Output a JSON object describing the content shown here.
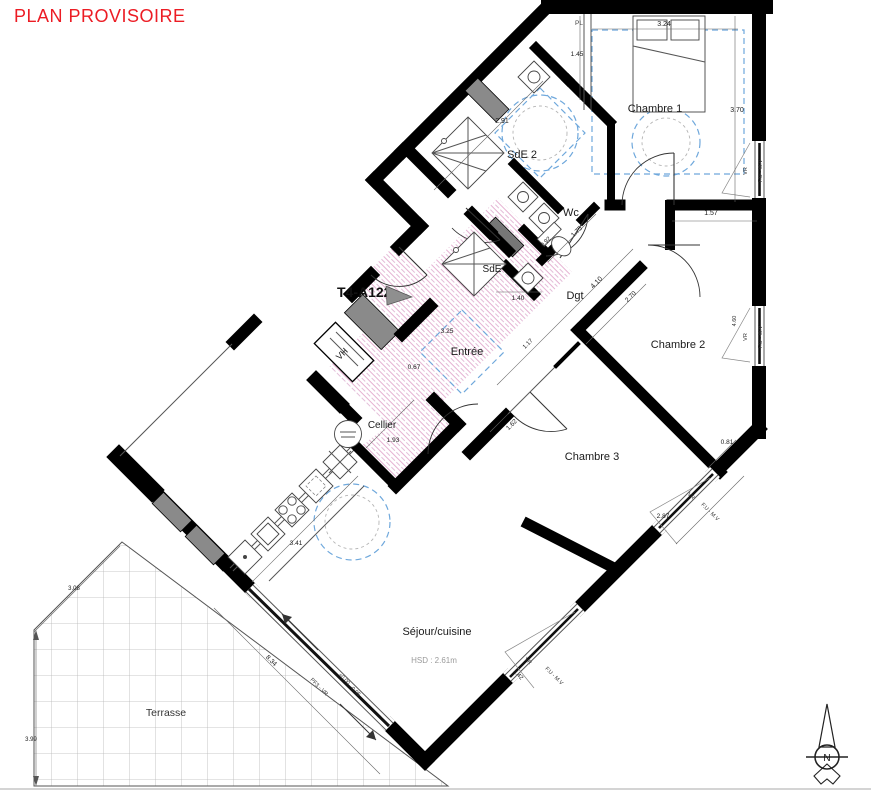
{
  "header": {
    "title": "PLAN PROVISOIRE",
    "color": "#ec1c24"
  },
  "unit": {
    "label": "T4-A122"
  },
  "compass": {
    "label": "N"
  },
  "colors": {
    "wall": "#000000",
    "accent_red": "#ec1c24",
    "hatch_pink": "#cf7fb4",
    "accessibility_blue": "#6fa8dc",
    "structural_gray": "#8a8a8a"
  },
  "labels": [
    {
      "id": "room-label-chambre1",
      "t": "Chambre 1",
      "x": 655,
      "y": 112,
      "s": 11
    },
    {
      "id": "room-label-chambre2",
      "t": "Chambre 2",
      "x": 678,
      "y": 348,
      "s": 11
    },
    {
      "id": "room-label-chambre3",
      "t": "Chambre 3",
      "x": 592,
      "y": 460,
      "s": 11
    },
    {
      "id": "room-label-sde2",
      "t": "SdE 2",
      "x": 522,
      "y": 158,
      "s": 11
    },
    {
      "id": "room-label-sde",
      "t": "SdE",
      "x": 492,
      "y": 272,
      "s": 10
    },
    {
      "id": "room-label-wc",
      "t": "Wc",
      "x": 571,
      "y": 216,
      "s": 11
    },
    {
      "id": "room-label-dgt",
      "t": "Dgt",
      "x": 575,
      "y": 299,
      "s": 11
    },
    {
      "id": "room-label-entree",
      "t": "Entrée",
      "x": 467,
      "y": 355,
      "s": 11
    },
    {
      "id": "room-label-cellier",
      "t": "Cellier",
      "x": 382,
      "y": 428,
      "s": 10
    },
    {
      "id": "room-label-sejour",
      "t": "Séjour/cuisine",
      "x": 437,
      "y": 635,
      "s": 11
    },
    {
      "id": "room-label-terrasse",
      "t": "Terrasse",
      "x": 166,
      "y": 716,
      "s": 10.5,
      "c": "#333333"
    },
    {
      "id": "ceiling-height-note",
      "t": "HSD : 2.61m",
      "x": 434,
      "y": 663,
      "s": 8,
      "c": "#9a9a9a"
    },
    {
      "id": "closet-label-pl",
      "t": "PL",
      "x": 575,
      "y": 25,
      "s": 6.5,
      "c": "#444444",
      "a": "start"
    },
    {
      "id": "duct-label-vh",
      "t": "VH",
      "x": 344,
      "y": 356,
      "s": 9,
      "r": -45
    },
    {
      "id": "window1-type",
      "t": "F.U - M.V",
      "x": 762,
      "y": 171,
      "s": 5.5,
      "r": -90,
      "c": "#333333"
    },
    {
      "id": "window1-shutter",
      "t": "VR",
      "x": 747,
      "y": 171,
      "s": 5.5,
      "r": -90,
      "c": "#333333"
    },
    {
      "id": "window2-type",
      "t": "F.U - M.V",
      "x": 762,
      "y": 337,
      "s": 5.5,
      "r": -90,
      "c": "#333333"
    },
    {
      "id": "window2-shutter",
      "t": "VR",
      "x": 747,
      "y": 337,
      "s": 5.5,
      "r": -90,
      "c": "#333333"
    },
    {
      "id": "window2-dim",
      "t": "4.60",
      "x": 736,
      "y": 321,
      "s": 5.5,
      "r": -90,
      "c": "#333333"
    },
    {
      "id": "window3-type",
      "t": "F.U - M.V",
      "x": 709,
      "y": 513,
      "s": 5.5,
      "r": 45,
      "c": "#333333"
    },
    {
      "id": "window3-shutter",
      "t": "VR",
      "x": 690,
      "y": 497,
      "s": 5.5,
      "r": 45,
      "c": "#333333"
    },
    {
      "id": "window4-type",
      "t": "F.U - M.V",
      "x": 553,
      "y": 677,
      "s": 5.5,
      "r": 45,
      "c": "#333333"
    },
    {
      "id": "window4-shutter",
      "t": "VR",
      "x": 527,
      "y": 662,
      "s": 5.5,
      "r": 45,
      "c": "#333333"
    },
    {
      "id": "window4-dim",
      "t": "3.42",
      "x": 517,
      "y": 676,
      "s": 6,
      "r": 45
    },
    {
      "id": "baywindow-type",
      "t": "PF3 - VR",
      "x": 318,
      "y": 688,
      "s": 5.5,
      "r": 45,
      "c": "#333333"
    },
    {
      "id": "floor-level-a",
      "t": "+0.00",
      "x": 343,
      "y": 680,
      "s": 5.5,
      "r": 45,
      "c": "#333333"
    },
    {
      "id": "floor-level-b",
      "t": "-0.05",
      "x": 354,
      "y": 692,
      "s": 5.5,
      "r": 45,
      "c": "#333333"
    },
    {
      "id": "dim-3-24",
      "t": "3.24",
      "x": 664,
      "y": 26,
      "s": 7
    },
    {
      "id": "dim-3-70",
      "t": "3.70",
      "x": 737,
      "y": 112,
      "s": 7
    },
    {
      "id": "dim-1-45",
      "t": "1.45",
      "x": 577,
      "y": 56,
      "s": 6.5
    },
    {
      "id": "dim-1-57",
      "t": "1.57",
      "x": 711,
      "y": 215,
      "s": 7
    },
    {
      "id": "dim-2-91",
      "t": "2.91",
      "x": 502,
      "y": 123,
      "s": 7
    },
    {
      "id": "dim-1-75",
      "t": "1.75",
      "x": 578,
      "y": 233,
      "s": 6.5,
      "r": -45
    },
    {
      "id": "dim-4-10",
      "t": "4.10",
      "x": 598,
      "y": 284,
      "s": 7,
      "r": -45
    },
    {
      "id": "dim-2-70",
      "t": "2.70",
      "x": 632,
      "y": 298,
      "s": 6.5,
      "r": -45
    },
    {
      "id": "dim-1-40",
      "t": "1.40",
      "x": 518,
      "y": 300,
      "s": 6.5
    },
    {
      "id": "dim-0-92",
      "t": "0.92",
      "x": 547,
      "y": 243,
      "s": 6,
      "r": -45
    },
    {
      "id": "dim-1-17",
      "t": "1.17",
      "x": 529,
      "y": 345,
      "s": 6,
      "r": -45
    },
    {
      "id": "dim-3-25",
      "t": "3.25",
      "x": 447,
      "y": 333,
      "s": 6.5
    },
    {
      "id": "dim-0-67",
      "t": "0.67",
      "x": 414,
      "y": 369,
      "s": 6.5
    },
    {
      "id": "dim-1-93",
      "t": "1.93",
      "x": 393,
      "y": 442,
      "s": 6.5
    },
    {
      "id": "dim-1-62",
      "t": "1.62",
      "x": 513,
      "y": 426,
      "s": 6.5,
      "r": -45
    },
    {
      "id": "dim-2-87",
      "t": "2.87",
      "x": 663,
      "y": 518,
      "s": 6.5
    },
    {
      "id": "dim-0-81",
      "t": "0.81",
      "x": 727,
      "y": 444,
      "s": 6.5
    },
    {
      "id": "dim-3-41",
      "t": "3.41",
      "x": 296,
      "y": 545,
      "s": 6.5
    },
    {
      "id": "dim-8-34",
      "t": "8.34",
      "x": 270,
      "y": 662,
      "s": 6.5,
      "r": 45
    },
    {
      "id": "dim-3-08",
      "t": "3.08",
      "x": 74,
      "y": 590,
      "s": 6
    },
    {
      "id": "dim-3-99",
      "t": "3.99",
      "x": 31,
      "y": 741,
      "s": 6
    }
  ]
}
